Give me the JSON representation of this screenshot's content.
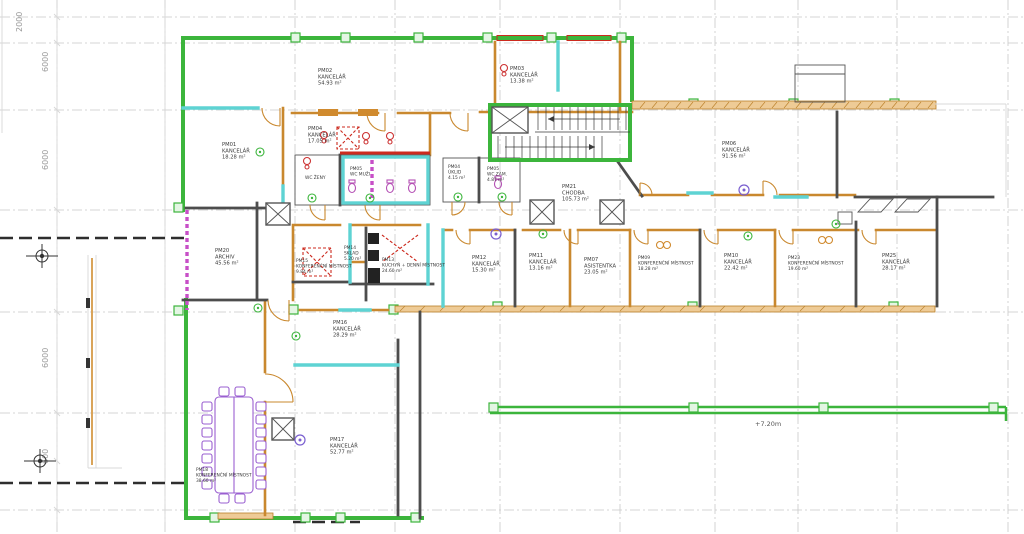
{
  "drawing": {
    "type": "architectural floor plan",
    "elevation_label": "+7.20m",
    "dimension_labels": [
      "2000",
      "6000",
      "6000",
      "6000",
      "600"
    ]
  },
  "colors": {
    "exterior_wall_green": "#3cb53c",
    "partition_wall_orange": "#c9882e",
    "structural_wall_gray": "#4d4d4d",
    "accent_cyan": "#5ed3d3",
    "window_red": "#cc2a1e",
    "highlight_magenta": "#c74fc7",
    "furniture_purple": "#9a5fd0",
    "grid_gray": "#c9c9c9"
  },
  "rooms": [
    {
      "id": "PM01",
      "name": "KANCELÁŘ",
      "area": "18.28 m²"
    },
    {
      "id": "PM02",
      "name": "KANCELÁŘ",
      "area": "54.93 m²"
    },
    {
      "id": "PM03",
      "name": "KANCELÁŘ",
      "area": "13.38 m²"
    },
    {
      "id": "PM04",
      "name": "KANCELÁŘ",
      "area": "17.05 m²"
    },
    {
      "id": "",
      "name": "WC ŽENY",
      "area": ""
    },
    {
      "id": "PM05",
      "name": "WC MUŽI",
      "area": ""
    },
    {
      "id": "PM04",
      "name": "ÚKLID",
      "area": "4.15 m²"
    },
    {
      "id": "PM05",
      "name": "WC ZAM.",
      "area": "4.87 m²"
    },
    {
      "id": "PM21",
      "name": "CHODBA",
      "area": "105.73 m²"
    },
    {
      "id": "PM06",
      "name": "KANCELÁŘ",
      "area": "91.56 m²"
    },
    {
      "id": "PM20",
      "name": "ARCHIV",
      "area": "45.56 m²"
    },
    {
      "id": "PM15",
      "name": "KONFERENČNÍ MÍSTNOST",
      "area": "9.84 m²"
    },
    {
      "id": "PM14",
      "name": "SKLAD",
      "area": "5.20 m²"
    },
    {
      "id": "PM13",
      "name": "KUCHYŇ + DENNÍ MÍSTNOST",
      "area": "24.60 m²"
    },
    {
      "id": "PM12",
      "name": "KANCELÁŘ",
      "area": "15.30 m²"
    },
    {
      "id": "PM11",
      "name": "KANCELÁŘ",
      "area": "13.16 m²"
    },
    {
      "id": "PM07",
      "name": "ASISTENTKA",
      "area": "23.05 m²"
    },
    {
      "id": "PM09",
      "name": "KONFERENČNÍ MÍSTNOST",
      "area": "18.28 m²"
    },
    {
      "id": "PM10",
      "name": "KANCELÁŘ",
      "area": "22.42 m²"
    },
    {
      "id": "PM23",
      "name": "KONFERENČNÍ MÍSTNOST",
      "area": "19.60 m²"
    },
    {
      "id": "PM25",
      "name": "KANCELÁŘ",
      "area": "28.17 m²"
    },
    {
      "id": "PM16",
      "name": "KANCELÁŘ",
      "area": "28.29 m²"
    },
    {
      "id": "PM17",
      "name": "KANCELÁŘ",
      "area": "52.77 m²"
    },
    {
      "id": "PM18",
      "name": "KONFERENČNÍ MÍSTNOST",
      "area": "38.60 m²"
    }
  ]
}
